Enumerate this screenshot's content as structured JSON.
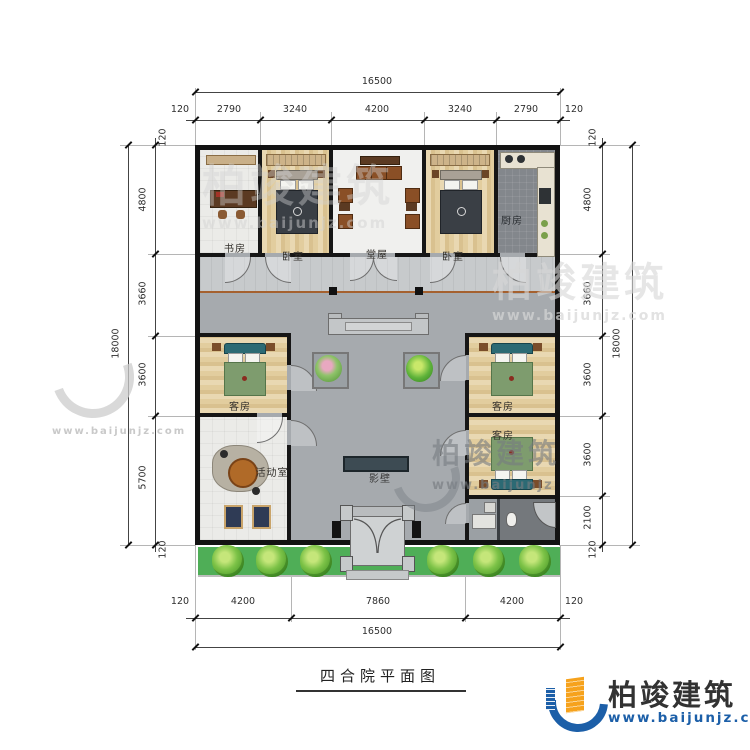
{
  "title": "四合院平面图",
  "plan": {
    "rooms": {
      "study": "书房",
      "bedroom_left": "卧室",
      "hall": "堂屋",
      "bedroom_right": "卧室",
      "kitchen": "厨房",
      "guest_left": "客房",
      "guest_right_upper": "客房",
      "guest_right_lower": "客房",
      "activity": "活动室",
      "screen_wall": "影壁"
    }
  },
  "dimensions": {
    "top": {
      "total": "16500",
      "segments": [
        "120",
        "2790",
        "3240",
        "4200",
        "3240",
        "2790",
        "120"
      ]
    },
    "bottom": {
      "total": "16500",
      "segments": [
        "120",
        "4200",
        "7860",
        "4200",
        "120"
      ]
    },
    "left": {
      "total": "18000",
      "segments": [
        "120",
        "4800",
        "3660",
        "3600",
        "5700",
        "120"
      ]
    },
    "right": {
      "total": "18000",
      "segments": [
        "120",
        "4800",
        "3660",
        "3600",
        "3600",
        "2100",
        "120"
      ]
    }
  },
  "brand": {
    "name": "柏竣建筑",
    "url": "www.baijunjz.com"
  },
  "watermark": {
    "name": "柏竣建筑",
    "url": "www.baijunjz.com",
    "url_short": "www.baijunjz"
  },
  "colors": {
    "wall": "#161616",
    "courtyard": "#a6aaae",
    "green_belt": "#4fae57",
    "screen_wall": "#3d4b53",
    "brand_blue": "#1c5fa8",
    "brand_orange": "#f6a21c"
  }
}
